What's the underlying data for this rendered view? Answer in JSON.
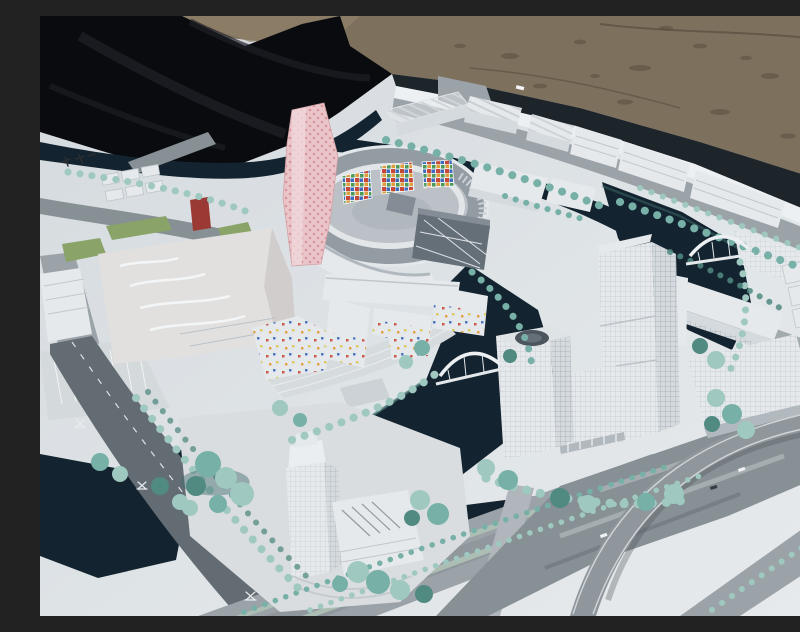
{
  "figure": {
    "medium": "outdoor photograph",
    "subject": "Architectural scale model of a canal-side urban district",
    "elements": [
      "white acrylic building blocks",
      "ring-shaped courtyard building with colorful mosaic wall panels",
      "tall pink dotted landmark tower",
      "low-rise blocks with scattered colored window squares",
      "dark teal canal network with two white arched bridges",
      "cluster of tall gridded office towers",
      "translucent riverside tower on an island",
      "teal model trees in rows and organic clusters",
      "gray roads, boulevard with planted medians, curved elevated ramp",
      "white display baseboard, black tarp at upper left, gravel ground behind"
    ],
    "visible_text": {
      "board_label": "tiny dark characters near the upper-left canal (illegible miniature print)",
      "road_labels": "tiny white characters painted on the dark roads (illegible miniature print)"
    }
  },
  "palette": {
    "sand": "#83745f",
    "sandDark": "#5e5141",
    "sandLight": "#97876e",
    "tarp": "#0b0b0e",
    "tarpFold": "#1f2126",
    "board": "#e8ecee",
    "boardEdge": "#f7f9fa",
    "shadowBand": "#1f252a",
    "water": "#14242f",
    "waterShallow": "#41706f",
    "road": "#8d959a",
    "roadDark": "#697076",
    "roadLight": "#a2a9ae",
    "grass": "#8fa96c",
    "treeLight": "#a5d0c6",
    "tree": "#7cb7ac",
    "treeDark": "#558f85",
    "building": "#f0f2f4",
    "buildingShade": "#dde2e5",
    "buildingDark": "#c3c8cc",
    "glass": "#6a737b",
    "glassLight": "#8a9299",
    "pinkTower": "#f3cdd0",
    "pinkDot": "#e59aa1",
    "redBuilding": "#a23c35",
    "cream": "#ebe9e7",
    "mosaicRed": "#d04a3c",
    "mosaicBlue": "#3f6fc4",
    "mosaicOrange": "#e8a23c",
    "mosaicGreen": "#4fa05a",
    "mosaicYellow": "#e3cf4e"
  }
}
